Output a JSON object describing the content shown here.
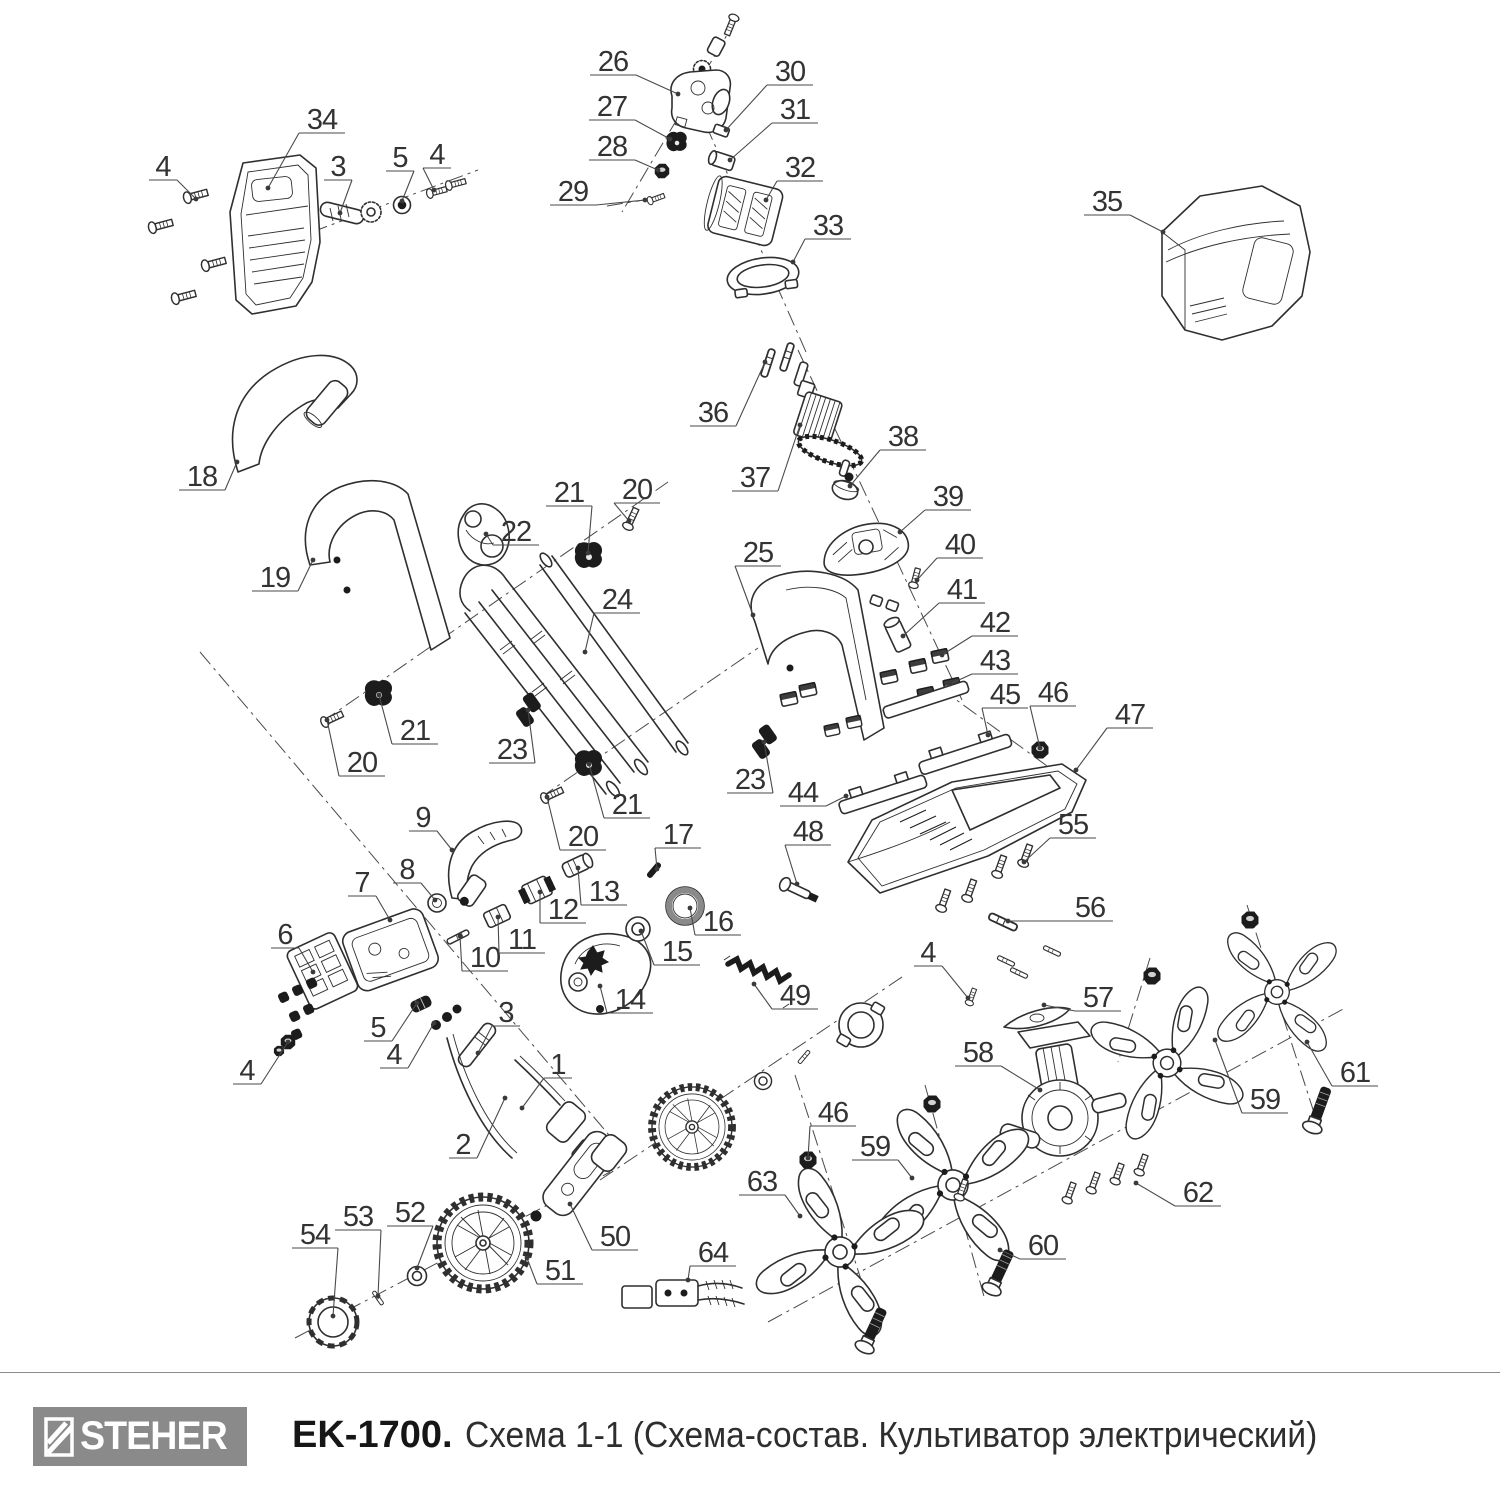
{
  "footer": {
    "brand": "STEHER",
    "model": "EK-1700.",
    "title": "Схема 1-1 (Схема-состав. Культиватор электрический)"
  },
  "diagram": {
    "background": "#ffffff",
    "line_color": "#2f2f2f",
    "accent_gray": "#8a8a8a",
    "labels": [
      {
        "n": "1",
        "x": 558,
        "y": 1065,
        "tx": 522,
        "ty": 1108
      },
      {
        "n": "2",
        "x": 463,
        "y": 1145,
        "tx": 505,
        "ty": 1098
      },
      {
        "n": "3",
        "x": 338,
        "y": 167,
        "tx": 340,
        "ty": 213
      },
      {
        "n": "3",
        "x": 506,
        "y": 1013,
        "tx": 478,
        "ty": 1053
      },
      {
        "n": "4",
        "x": 163,
        "y": 167,
        "tx": 196,
        "ty": 199
      },
      {
        "n": "4",
        "x": 437,
        "y": 155,
        "tx": 434,
        "ty": 190
      },
      {
        "n": "4",
        "x": 247,
        "y": 1071,
        "tx": 288,
        "ty": 1042
      },
      {
        "n": "4",
        "x": 394,
        "y": 1055,
        "tx": 434,
        "ty": 1023
      },
      {
        "n": "4",
        "x": 928,
        "y": 953,
        "tx": 968,
        "ty": 998
      },
      {
        "n": "5",
        "x": 400,
        "y": 158,
        "tx": 402,
        "ty": 201
      },
      {
        "n": "5",
        "x": 378,
        "y": 1028,
        "tx": 417,
        "ty": 1003
      },
      {
        "n": "6",
        "x": 285,
        "y": 935,
        "tx": 313,
        "ty": 972
      },
      {
        "n": "7",
        "x": 362,
        "y": 883,
        "tx": 390,
        "ty": 920
      },
      {
        "n": "8",
        "x": 407,
        "y": 870,
        "tx": 435,
        "ty": 900
      },
      {
        "n": "9",
        "x": 423,
        "y": 818,
        "tx": 452,
        "ty": 850
      },
      {
        "n": "10",
        "x": 485,
        "y": 958,
        "tx": 460,
        "ty": 936
      },
      {
        "n": "11",
        "x": 522,
        "y": 940,
        "tx": 498,
        "ty": 917
      },
      {
        "n": "12",
        "x": 563,
        "y": 910,
        "tx": 540,
        "ty": 892
      },
      {
        "n": "13",
        "x": 604,
        "y": 892,
        "tx": 578,
        "ty": 868
      },
      {
        "n": "14",
        "x": 630,
        "y": 1000,
        "tx": 600,
        "ty": 986
      },
      {
        "n": "15",
        "x": 677,
        "y": 952,
        "tx": 641,
        "ty": 931
      },
      {
        "n": "16",
        "x": 718,
        "y": 922,
        "tx": 690,
        "ty": 908
      },
      {
        "n": "17",
        "x": 678,
        "y": 835,
        "tx": 657,
        "ty": 869
      },
      {
        "n": "18",
        "x": 202,
        "y": 477,
        "tx": 237,
        "ty": 462
      },
      {
        "n": "19",
        "x": 275,
        "y": 578,
        "tx": 313,
        "ty": 560
      },
      {
        "n": "20",
        "x": 637,
        "y": 490,
        "tx": 629,
        "ty": 521
      },
      {
        "n": "20",
        "x": 362,
        "y": 763,
        "tx": 327,
        "ty": 720
      },
      {
        "n": "20",
        "x": 583,
        "y": 837,
        "tx": 547,
        "ty": 797
      },
      {
        "n": "21",
        "x": 569,
        "y": 493,
        "tx": 588,
        "ty": 553
      },
      {
        "n": "21",
        "x": 415,
        "y": 731,
        "tx": 379,
        "ty": 695
      },
      {
        "n": "21",
        "x": 627,
        "y": 805,
        "tx": 589,
        "ty": 764
      },
      {
        "n": "22",
        "x": 516,
        "y": 532,
        "tx": 486,
        "ty": 534
      },
      {
        "n": "23",
        "x": 512,
        "y": 750,
        "tx": 528,
        "ty": 710
      },
      {
        "n": "23",
        "x": 750,
        "y": 780,
        "tx": 764,
        "ty": 742
      },
      {
        "n": "24",
        "x": 617,
        "y": 600,
        "tx": 585,
        "ty": 652
      },
      {
        "n": "25",
        "x": 758,
        "y": 553,
        "tx": 753,
        "ty": 615
      },
      {
        "n": "26",
        "x": 613,
        "y": 62,
        "tx": 678,
        "ty": 94
      },
      {
        "n": "27",
        "x": 612,
        "y": 107,
        "tx": 670,
        "ty": 139
      },
      {
        "n": "28",
        "x": 612,
        "y": 147,
        "tx": 658,
        "ty": 170
      },
      {
        "n": "29",
        "x": 573,
        "y": 192,
        "tx": 645,
        "ty": 200
      },
      {
        "n": "30",
        "x": 790,
        "y": 72,
        "tx": 726,
        "ty": 130
      },
      {
        "n": "31",
        "x": 795,
        "y": 110,
        "tx": 730,
        "ty": 160
      },
      {
        "n": "32",
        "x": 800,
        "y": 168,
        "tx": 766,
        "ty": 200
      },
      {
        "n": "33",
        "x": 828,
        "y": 226,
        "tx": 793,
        "ty": 262
      },
      {
        "n": "34",
        "x": 322,
        "y": 120,
        "tx": 268,
        "ty": 188
      },
      {
        "n": "35",
        "x": 1107,
        "y": 202,
        "tx": 1163,
        "ty": 232
      },
      {
        "n": "36",
        "x": 713,
        "y": 413,
        "tx": 765,
        "ty": 362
      },
      {
        "n": "37",
        "x": 755,
        "y": 478,
        "tx": 800,
        "ty": 425
      },
      {
        "n": "38",
        "x": 903,
        "y": 437,
        "tx": 850,
        "ty": 486
      },
      {
        "n": "39",
        "x": 948,
        "y": 497,
        "tx": 900,
        "ty": 532
      },
      {
        "n": "40",
        "x": 960,
        "y": 545,
        "tx": 917,
        "ty": 580
      },
      {
        "n": "41",
        "x": 962,
        "y": 590,
        "tx": 903,
        "ty": 636
      },
      {
        "n": "42",
        "x": 995,
        "y": 623,
        "tx": 942,
        "ty": 655
      },
      {
        "n": "43",
        "x": 995,
        "y": 661,
        "tx": 950,
        "ty": 684
      },
      {
        "n": "44",
        "x": 803,
        "y": 793,
        "tx": 846,
        "ty": 796
      },
      {
        "n": "45",
        "x": 1005,
        "y": 695,
        "tx": 988,
        "ty": 735
      },
      {
        "n": "46",
        "x": 1053,
        "y": 693,
        "tx": 1040,
        "ty": 748
      },
      {
        "n": "46",
        "x": 833,
        "y": 1113,
        "tx": 808,
        "ty": 1158
      },
      {
        "n": "47",
        "x": 1130,
        "y": 715,
        "tx": 1076,
        "ty": 770
      },
      {
        "n": "48",
        "x": 808,
        "y": 832,
        "tx": 797,
        "ty": 884
      },
      {
        "n": "49",
        "x": 795,
        "y": 996,
        "tx": 754,
        "ty": 984
      },
      {
        "n": "50",
        "x": 615,
        "y": 1237,
        "tx": 570,
        "ty": 1204
      },
      {
        "n": "51",
        "x": 560,
        "y": 1271,
        "tx": 527,
        "ty": 1258
      },
      {
        "n": "52",
        "x": 410,
        "y": 1213,
        "tx": 417,
        "ty": 1268
      },
      {
        "n": "53",
        "x": 358,
        "y": 1217,
        "tx": 378,
        "ty": 1296
      },
      {
        "n": "54",
        "x": 315,
        "y": 1235,
        "tx": 333,
        "ty": 1316
      },
      {
        "n": "55",
        "x": 1073,
        "y": 825,
        "tx": 1024,
        "ty": 862
      },
      {
        "n": "56",
        "x": 1090,
        "y": 908,
        "tx": 1008,
        "ty": 921
      },
      {
        "n": "57",
        "x": 1098,
        "y": 998,
        "tx": 1044,
        "ty": 1005
      },
      {
        "n": "58",
        "x": 978,
        "y": 1053,
        "tx": 1040,
        "ty": 1090
      },
      {
        "n": "59",
        "x": 875,
        "y": 1147,
        "tx": 912,
        "ty": 1178
      },
      {
        "n": "59",
        "x": 1265,
        "y": 1100,
        "tx": 1215,
        "ty": 1040
      },
      {
        "n": "60",
        "x": 1043,
        "y": 1246,
        "tx": 1000,
        "ty": 1250
      },
      {
        "n": "61",
        "x": 1355,
        "y": 1073,
        "tx": 1307,
        "ty": 1042
      },
      {
        "n": "62",
        "x": 1198,
        "y": 1193,
        "tx": 1136,
        "ty": 1183
      },
      {
        "n": "63",
        "x": 762,
        "y": 1182,
        "tx": 800,
        "ty": 1216
      },
      {
        "n": "64",
        "x": 713,
        "y": 1253,
        "tx": 688,
        "ty": 1280
      }
    ]
  }
}
